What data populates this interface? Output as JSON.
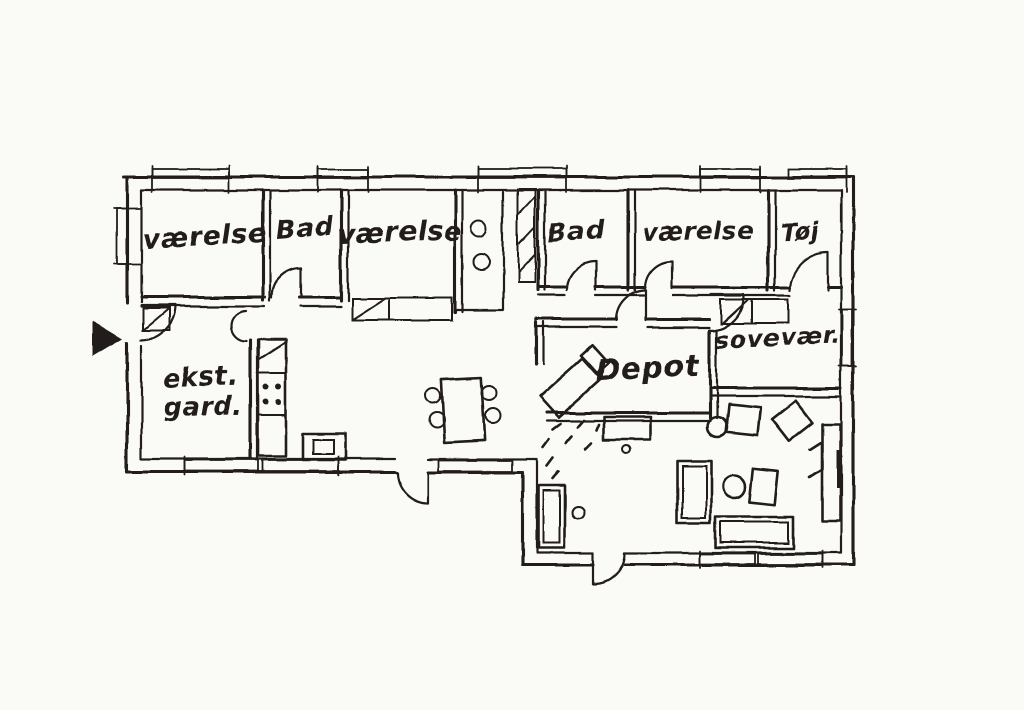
{
  "drawing": {
    "type": "hand-drawn floor plan sketch",
    "colors": {
      "paper": "#fafaf6",
      "ink": "#231f1c"
    },
    "rooms": {
      "vaerelse_nw": {
        "label": "værelse"
      },
      "bad_w": {
        "label": "Bad"
      },
      "vaerelse_n": {
        "label": "værelse"
      },
      "bad_e": {
        "label": "Bad"
      },
      "vaerelse_ne": {
        "label": "værelse"
      },
      "toj": {
        "label": "Tøj"
      },
      "sovevaerelse": {
        "label": "sovevær."
      },
      "depot": {
        "label": "Depot"
      },
      "ekst_gard": {
        "line1": "ekst.",
        "line2": "gard."
      }
    },
    "markers": {
      "entrance_arrow": "filled triangle pointing right at entrance door"
    }
  }
}
